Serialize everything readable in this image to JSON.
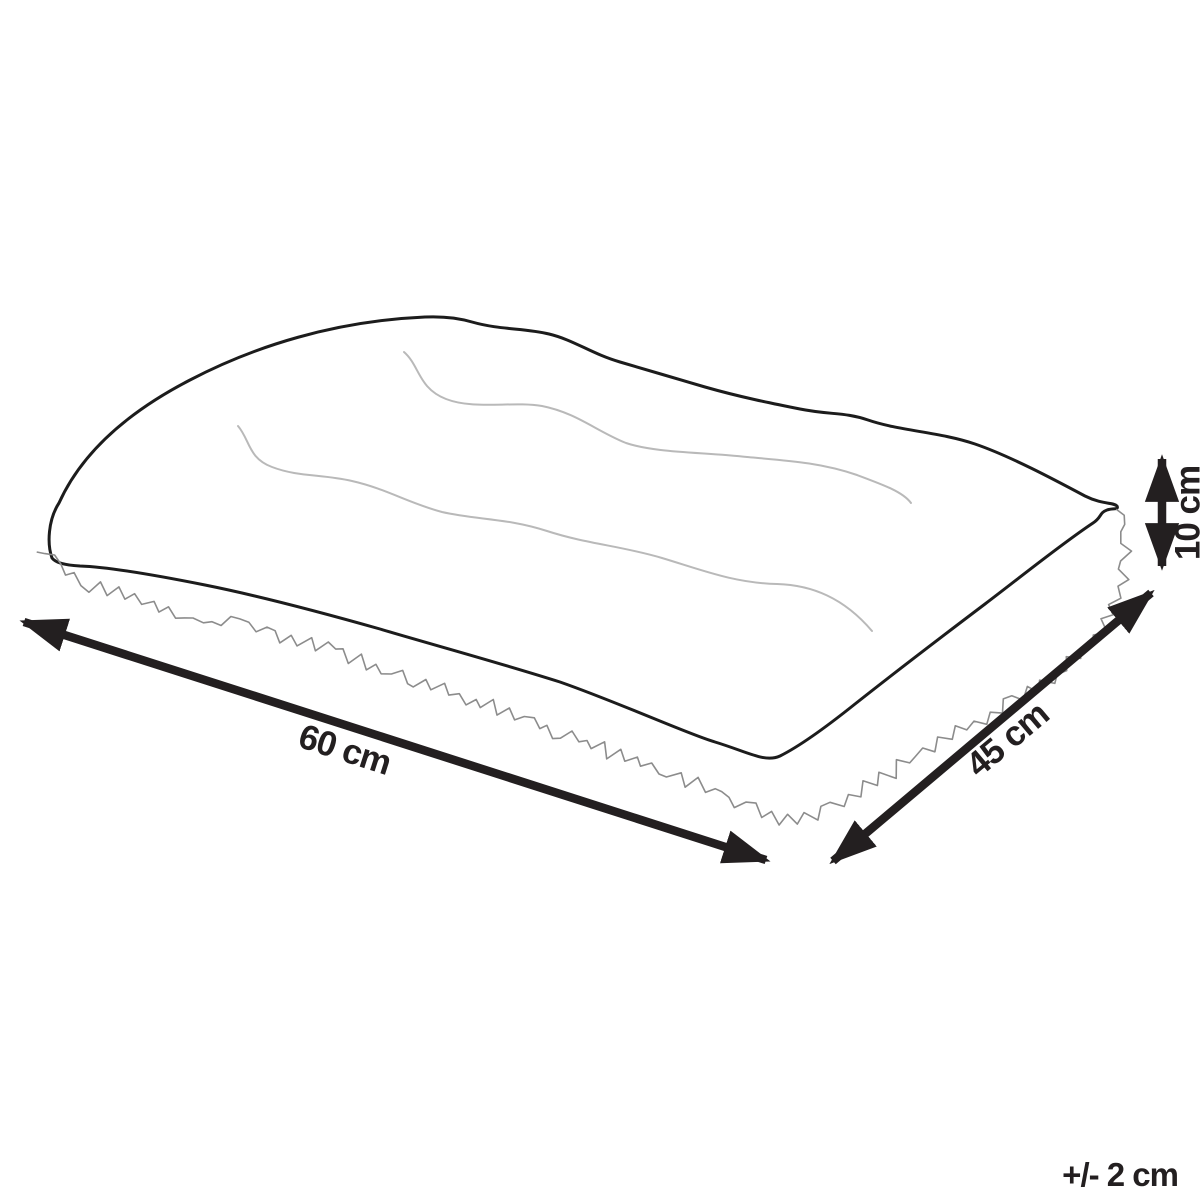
{
  "diagram": {
    "labels": {
      "width": "60 cm",
      "depth": "45 cm",
      "height": "10 cm",
      "tolerance": "+/- 2 cm"
    },
    "colors": {
      "ink": "#231f20",
      "outline": "#1c1c1c",
      "quilt": "#b9b9b9",
      "fur": "#8c8c8c",
      "background": "#ffffff"
    }
  }
}
